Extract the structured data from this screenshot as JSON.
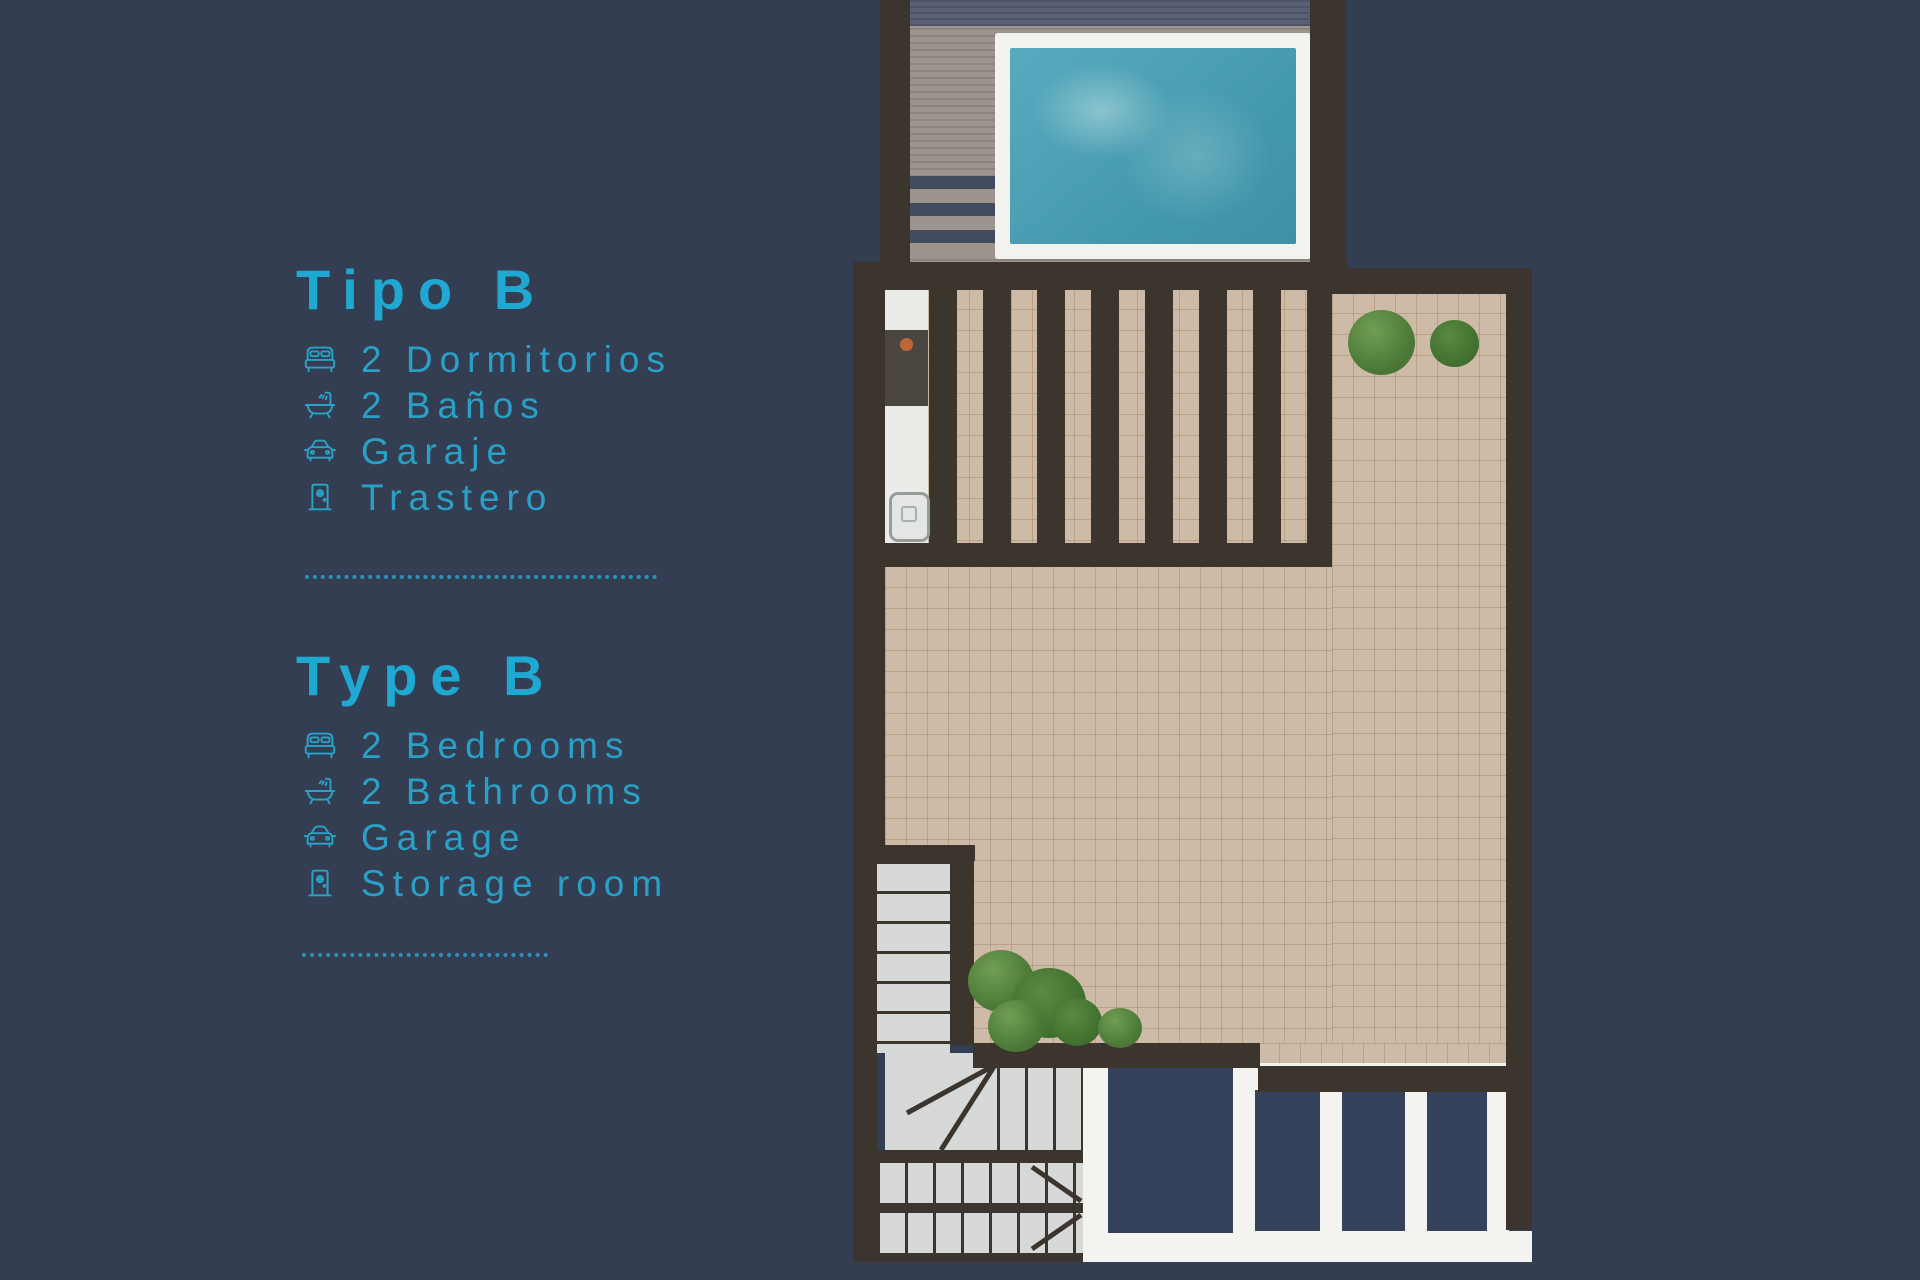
{
  "page": {
    "background_color": "#343e52",
    "accent_color": "#1fa9d2"
  },
  "listing": {
    "spanish": {
      "title": "Tipo B",
      "items": [
        {
          "icon": "bed-icon",
          "label": "2 Dormitorios"
        },
        {
          "icon": "bathtub-icon",
          "label": "2 Baños"
        },
        {
          "icon": "car-icon",
          "label": "Garaje"
        },
        {
          "icon": "door-icon",
          "label": "Trastero"
        }
      ]
    },
    "english": {
      "title": "Type B",
      "items": [
        {
          "icon": "bed-icon",
          "label": "2 Bedrooms"
        },
        {
          "icon": "bathtub-icon",
          "label": "2 Bathrooms"
        },
        {
          "icon": "car-icon",
          "label": "Garage"
        },
        {
          "icon": "door-icon",
          "label": "Storage room"
        }
      ]
    }
  },
  "floor_plan": {
    "type": "roof-terrace-plan",
    "features": [
      "swimming-pool",
      "wood-deck",
      "pergola",
      "outdoor-kitchen",
      "sink",
      "grill",
      "tiled-terrace",
      "plants",
      "u-shaped-staircase",
      "glass-balustrade"
    ],
    "colors": {
      "wall": "#3b352e",
      "tile": "#cdbba7",
      "pool_water": "#4fa5ba",
      "pool_border": "#f2f2ef",
      "deck": "#9d948d",
      "stairs": "#d7d9d8",
      "plants": "#5c8a42"
    }
  }
}
